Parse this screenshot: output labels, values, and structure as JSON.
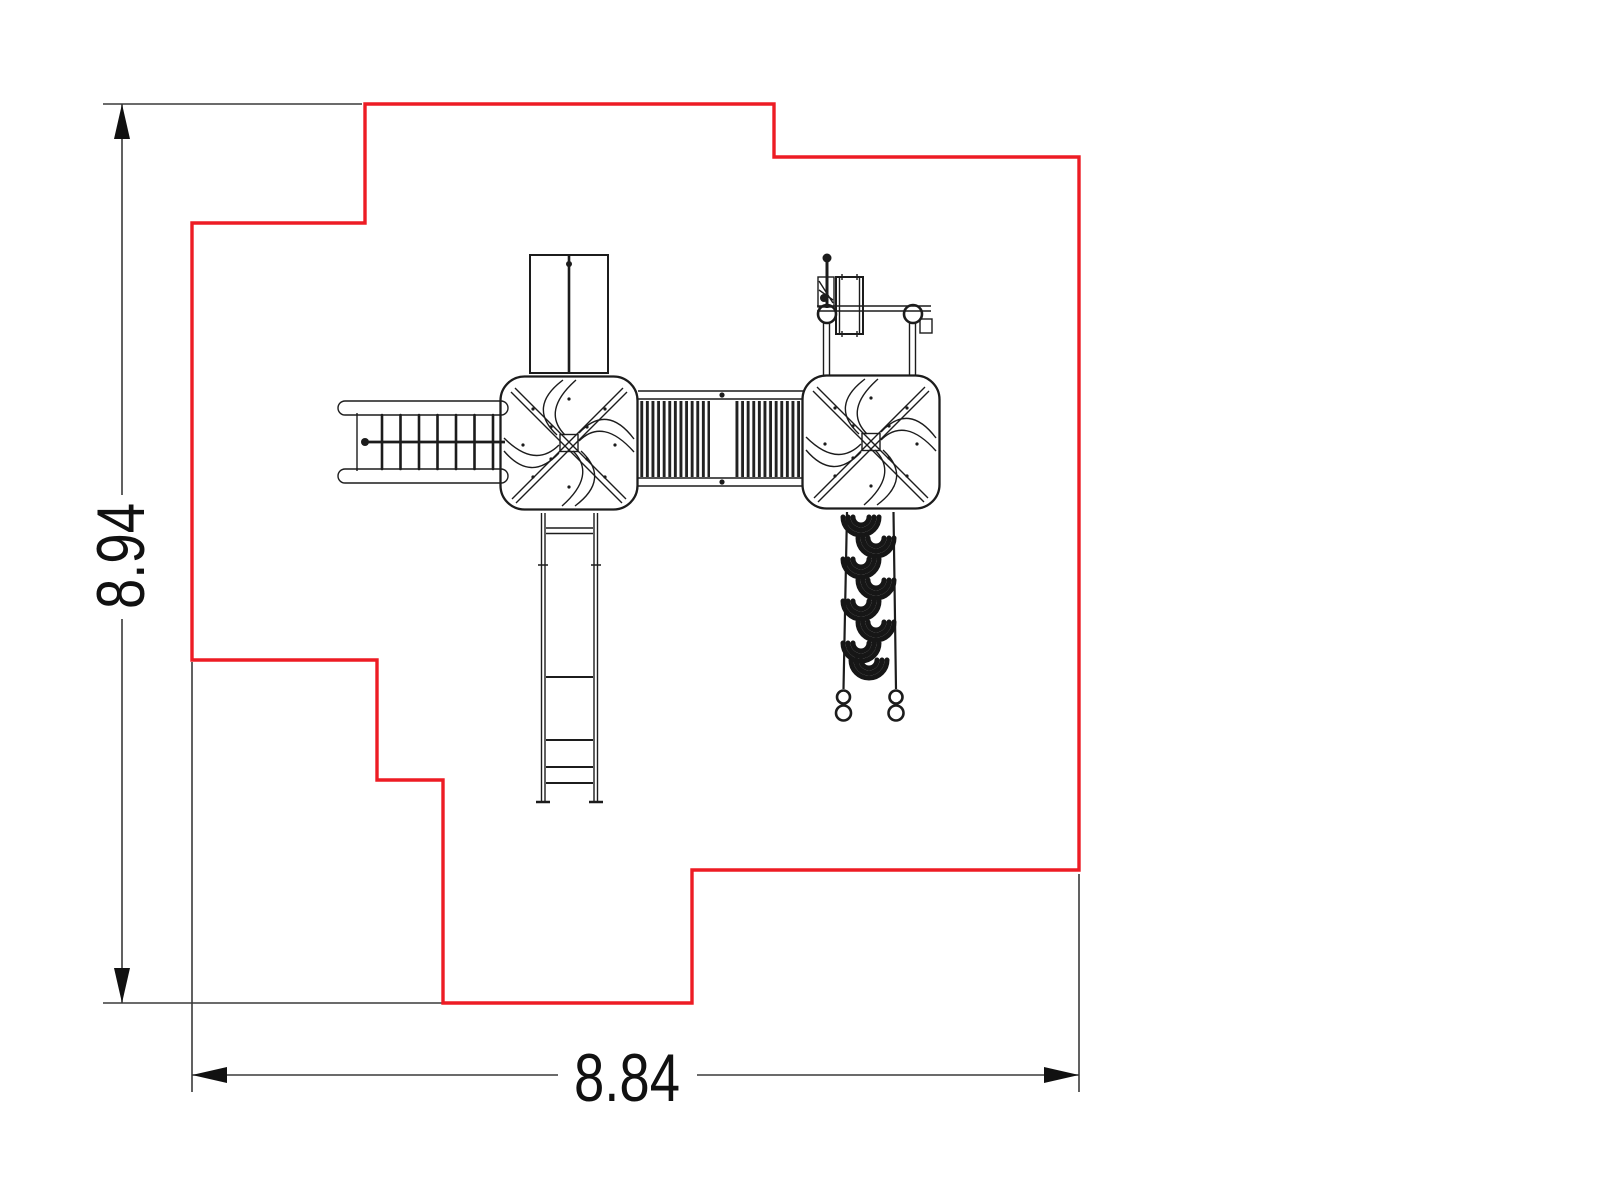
{
  "drawing": {
    "description": "Top-view CAD plan of a playground play structure with stepped safety-zone boundary",
    "dimension_height": "8.94",
    "dimension_width": "8.84",
    "colors": {
      "boundary": "#ed1c24",
      "linework": "#1c1c1c",
      "dimension": "#3a3a3a",
      "text": "#111111",
      "background": "#ffffff"
    }
  }
}
